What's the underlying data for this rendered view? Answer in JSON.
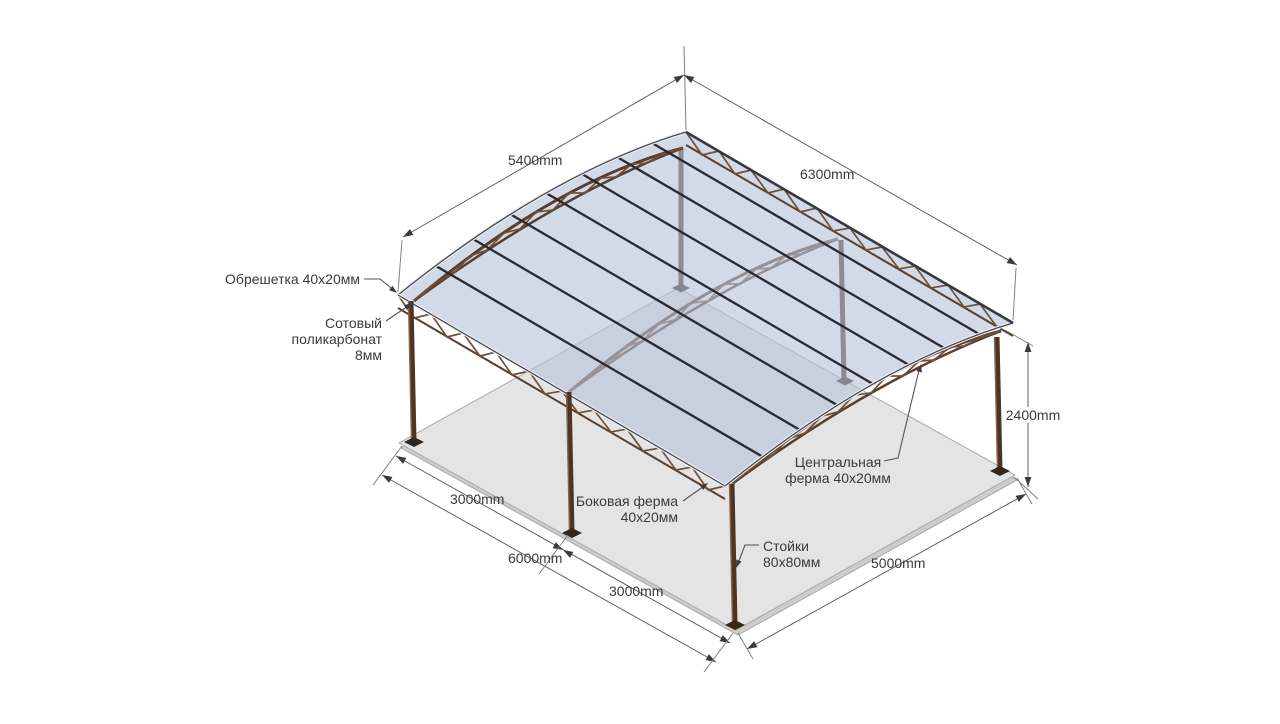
{
  "drawing_title": "Arched polycarbonate canopy technical drawing",
  "dimensions": {
    "roof_arc": "5400mm",
    "roof_length": "6300mm",
    "post_height": "2400mm",
    "bay_first": "3000mm",
    "side_total": "6000mm",
    "bay_second": "3000mm",
    "floor_width": "5000mm"
  },
  "labels": {
    "lathing": "Обрешетка 40х20мм",
    "polycarbonate": "Сотовый\nполикарбонат\n8мм",
    "side_truss": "Боковая ферма\n40х20мм",
    "central_truss": "Центральная\nферма 40х20мм",
    "posts": "Стойки\n80х80мм"
  },
  "colors": {
    "floor": "#e4e4e4",
    "floor_side": "#cccccc",
    "floor_edge": "#a8a8a8",
    "panel": "#b6c2d8",
    "truss": "#5a3f2c",
    "truss_web": "#6f5138",
    "post": "#4e3423",
    "post_hl": "#8a6648",
    "plate": "#33271c",
    "purlin": "#2a2a30",
    "rim_light": "#eef0f5",
    "rim_dark": "#4a4a50",
    "ridge": "#38383c",
    "dim": "#606060",
    "ext": "#808080",
    "arrow": "#3c3c3c",
    "leader": "#555555",
    "text": "#3a3a3a"
  }
}
